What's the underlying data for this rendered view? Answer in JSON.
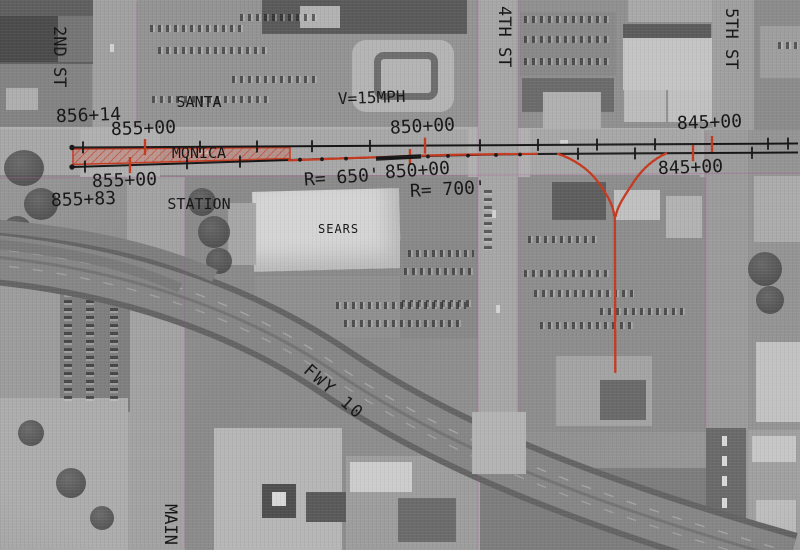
{
  "labels": {
    "street_2nd": "2ND ST",
    "street_4th": "4TH ST",
    "street_5th": "5TH ST",
    "street_main": "MAIN",
    "freeway": "FWY 10",
    "station_name_line1": "SANTA",
    "station_name_line2": "MONICA",
    "station_name_line3": "STATION",
    "building_sears": "SEARS",
    "speed_restriction": "V=15MPH",
    "sta_856_14": "856+14",
    "sta_855_00_upper": "855+00",
    "sta_855_00_lower": "855+00",
    "sta_855_83": "855+83",
    "sta_850_00_upper": "850+00",
    "sta_850_00_lower": "850+00",
    "sta_845_00_upper": "845+00",
    "sta_845_00_lower": "845+00",
    "radius_650": "R= 650'",
    "radius_700": "R= 700'"
  },
  "colors": {
    "annotation_red": "#c7391e",
    "annotation_black": "#161616",
    "platform_hatch_fill": "rgba(216,92,70,0.30)"
  }
}
